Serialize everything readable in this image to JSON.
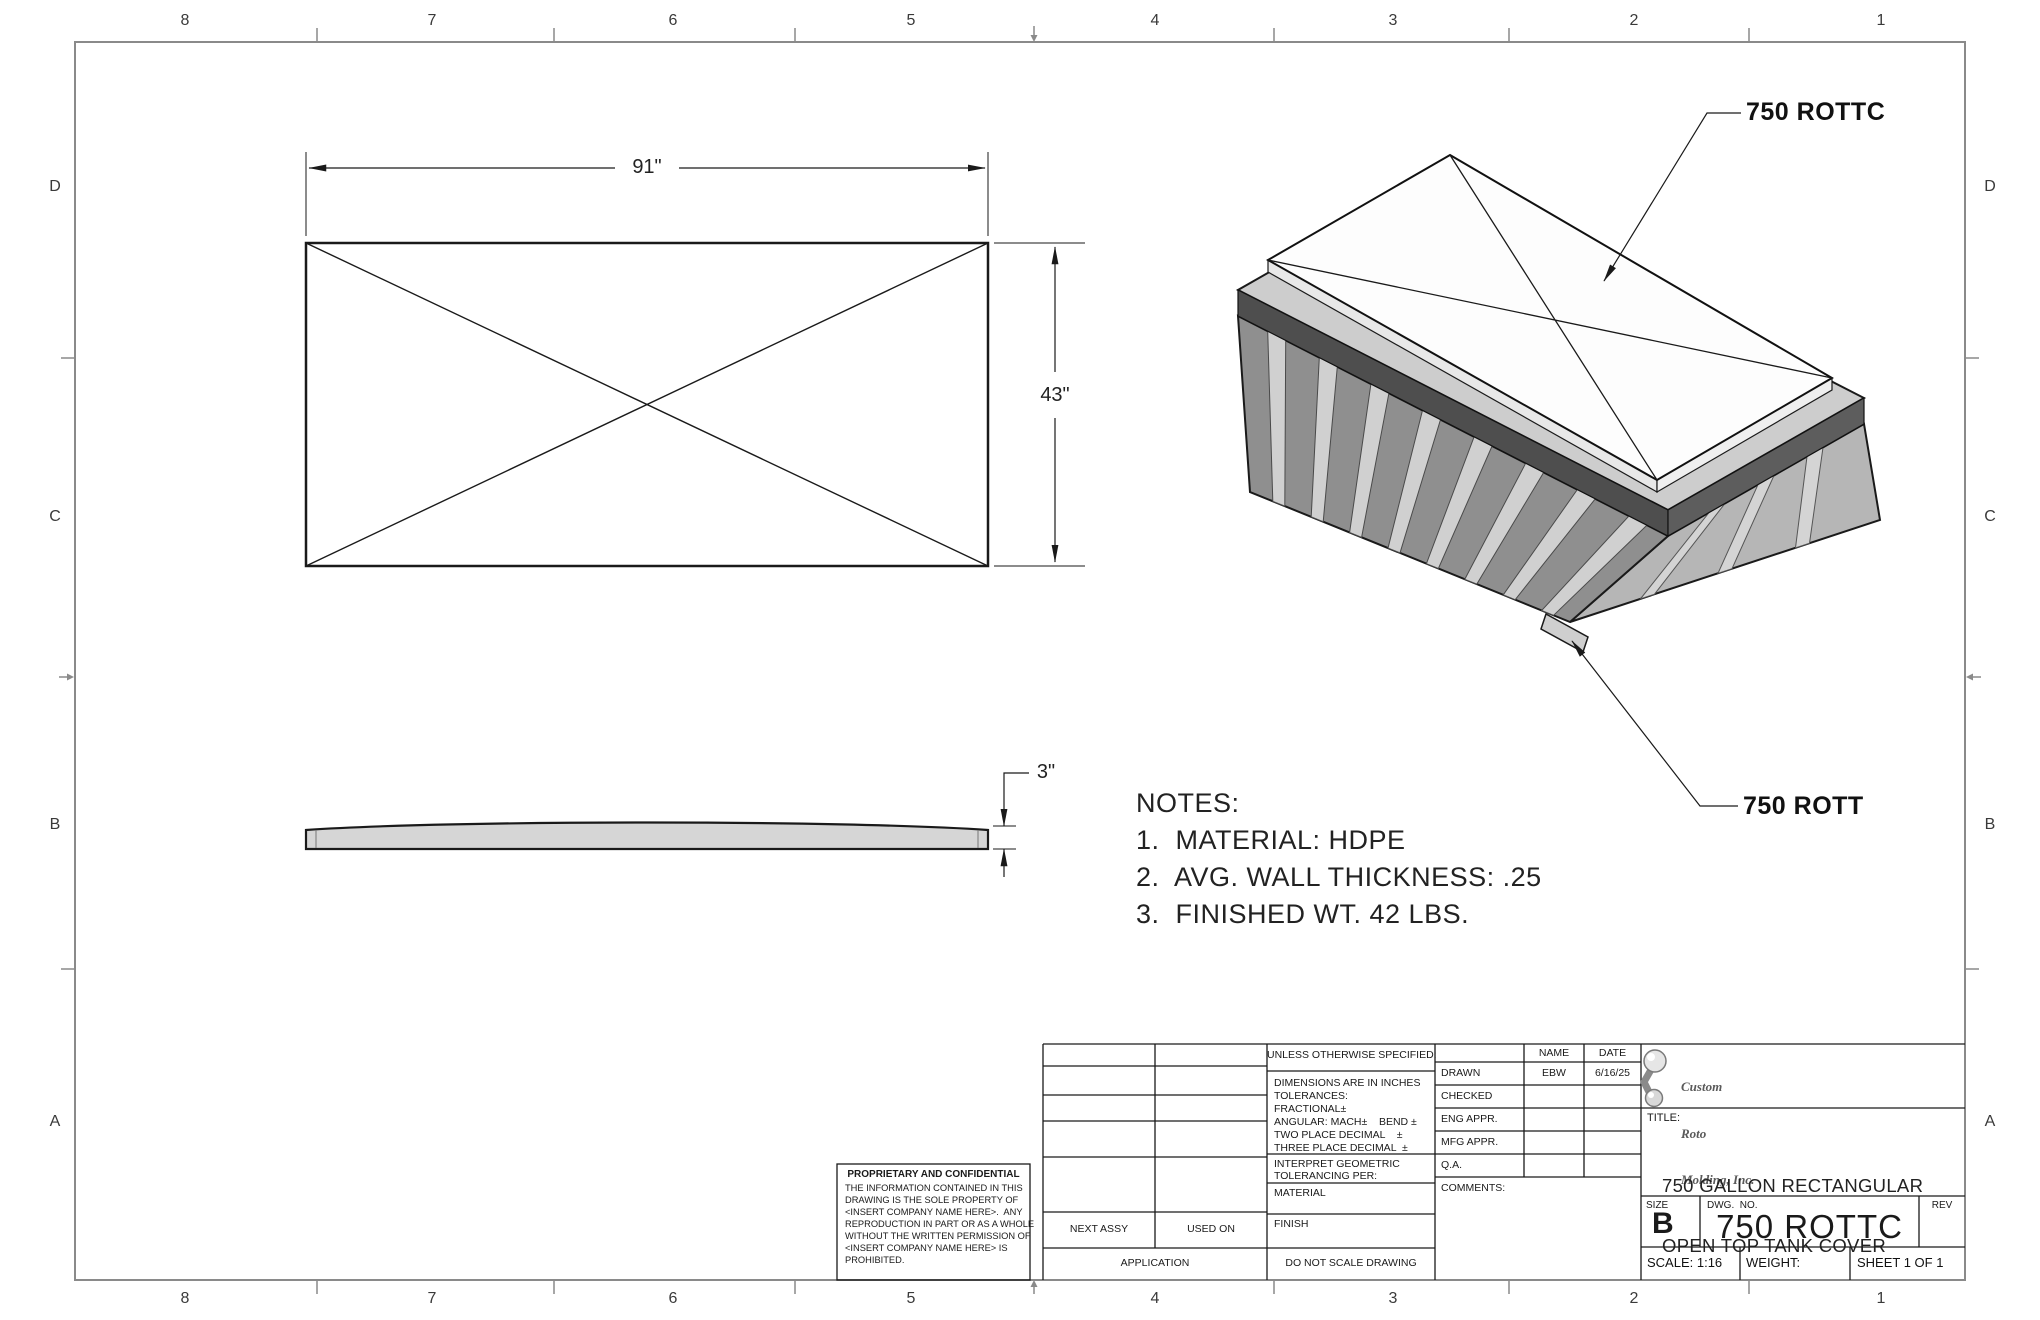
{
  "sheet": {
    "zones_top": [
      "8",
      "7",
      "6",
      "5",
      "4",
      "3",
      "2",
      "1"
    ],
    "zones_bottom": [
      "8",
      "7",
      "6",
      "5",
      "4",
      "3",
      "2",
      "1"
    ],
    "zones_left": [
      "D",
      "C",
      "B",
      "A"
    ],
    "zones_right": [
      "D",
      "C",
      "B",
      "A"
    ]
  },
  "views": {
    "top": {
      "dim_width": "91\"",
      "dim_height": "43\""
    },
    "side": {
      "dim_thickness": "3\""
    },
    "iso": {
      "label_cover": "750 ROTTC",
      "label_tank": "750 ROTT"
    }
  },
  "notes": {
    "heading": "NOTES:",
    "items": [
      "1.  MATERIAL: HDPE",
      "2.  AVG. WALL THICKNESS: .25",
      "3.  FINISHED WT. 42 LBS."
    ]
  },
  "proprietary": {
    "heading": "PROPRIETARY AND CONFIDENTIAL",
    "lines": [
      "THE INFORMATION CONTAINED IN THIS",
      "DRAWING IS THE SOLE PROPERTY OF",
      "<INSERT COMPANY NAME HERE>.  ANY",
      "REPRODUCTION IN PART OR AS A WHOLE",
      "WITHOUT THE WRITTEN PERMISSION OF",
      "<INSERT COMPANY NAME HERE> IS",
      "PROHIBITED."
    ]
  },
  "application": {
    "next_assy": "NEXT ASSY",
    "used_on": "USED ON",
    "label": "APPLICATION"
  },
  "uos": {
    "heading": "UNLESS OTHERWISE SPECIFIED:",
    "lines": [
      "DIMENSIONS ARE IN INCHES",
      "TOLERANCES:",
      "FRACTIONAL±",
      "ANGULAR: MACH±    BEND ±",
      "TWO PLACE DECIMAL    ±",
      "THREE PLACE DECIMAL  ±"
    ],
    "interpret_line1": "INTERPRET GEOMETRIC",
    "interpret_line2": "TOLERANCING PER:",
    "material_label": "MATERIAL",
    "finish_label": "FINISH",
    "do_not_scale": "DO NOT SCALE DRAWING"
  },
  "approvals": {
    "name_header": "NAME",
    "date_header": "DATE",
    "rows": [
      {
        "label": "DRAWN",
        "name": "EBW",
        "date": "6/16/25"
      },
      {
        "label": "CHECKED",
        "name": "",
        "date": ""
      },
      {
        "label": "ENG APPR.",
        "name": "",
        "date": ""
      },
      {
        "label": "MFG APPR.",
        "name": "",
        "date": ""
      },
      {
        "label": "Q.A.",
        "name": "",
        "date": ""
      }
    ],
    "comments_label": "COMMENTS:"
  },
  "title_block": {
    "logo_lines": [
      "Custom",
      "Roto",
      "Molding, Inc."
    ],
    "title_label": "TITLE:",
    "title_lines": [
      "750 GALLON RECTANGULAR",
      "OPEN TOP TANK COVER"
    ],
    "size_label": "SIZE",
    "size_value": "B",
    "dwg_label": "DWG.  NO.",
    "dwg_value": "750 ROTTC",
    "rev_label": "REV",
    "scale": "SCALE: 1:16",
    "weight": "WEIGHT:",
    "sheet": "SHEET 1 OF 1"
  }
}
